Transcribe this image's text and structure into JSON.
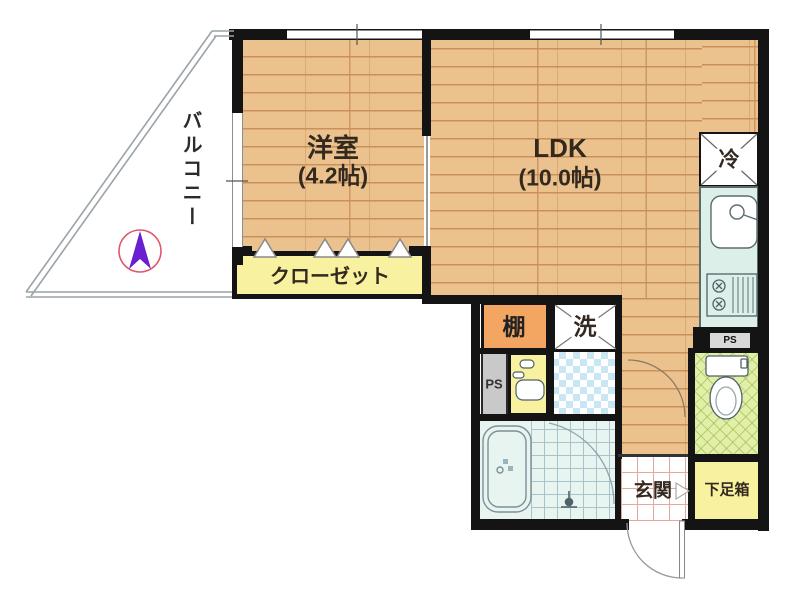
{
  "floor_plan": {
    "rooms": {
      "balcony": {
        "label": "バルコニー"
      },
      "western_room": {
        "label": "洋室",
        "size": "(4.2帖)"
      },
      "ldk": {
        "label": "LDK",
        "size": "(10.0帖)"
      },
      "closet": {
        "label": "クローゼット"
      },
      "refrigerator": {
        "label": "冷"
      },
      "shelf": {
        "label": "棚"
      },
      "washer": {
        "label": "洗"
      },
      "pipe_space_right": {
        "label": "PS"
      },
      "pipe_space_left": {
        "label": "PS"
      },
      "entrance": {
        "label": "玄関"
      },
      "shoe_box": {
        "label": "下足箱"
      }
    },
    "colors": {
      "wall": "#141414",
      "wood": "#EBC28E",
      "wood-line": "#C9905A",
      "yellow": "#F8F2A0",
      "orange": "#F2A661",
      "mint": "#DCEFE8",
      "check": "#C9E6F4",
      "tgreen": "#E2EFA9",
      "entry": "#E4A89E",
      "ps-gray": "#C9C9C9",
      "compass-purple": "#6A1FD0",
      "compass-ring": "#E0556A"
    }
  }
}
